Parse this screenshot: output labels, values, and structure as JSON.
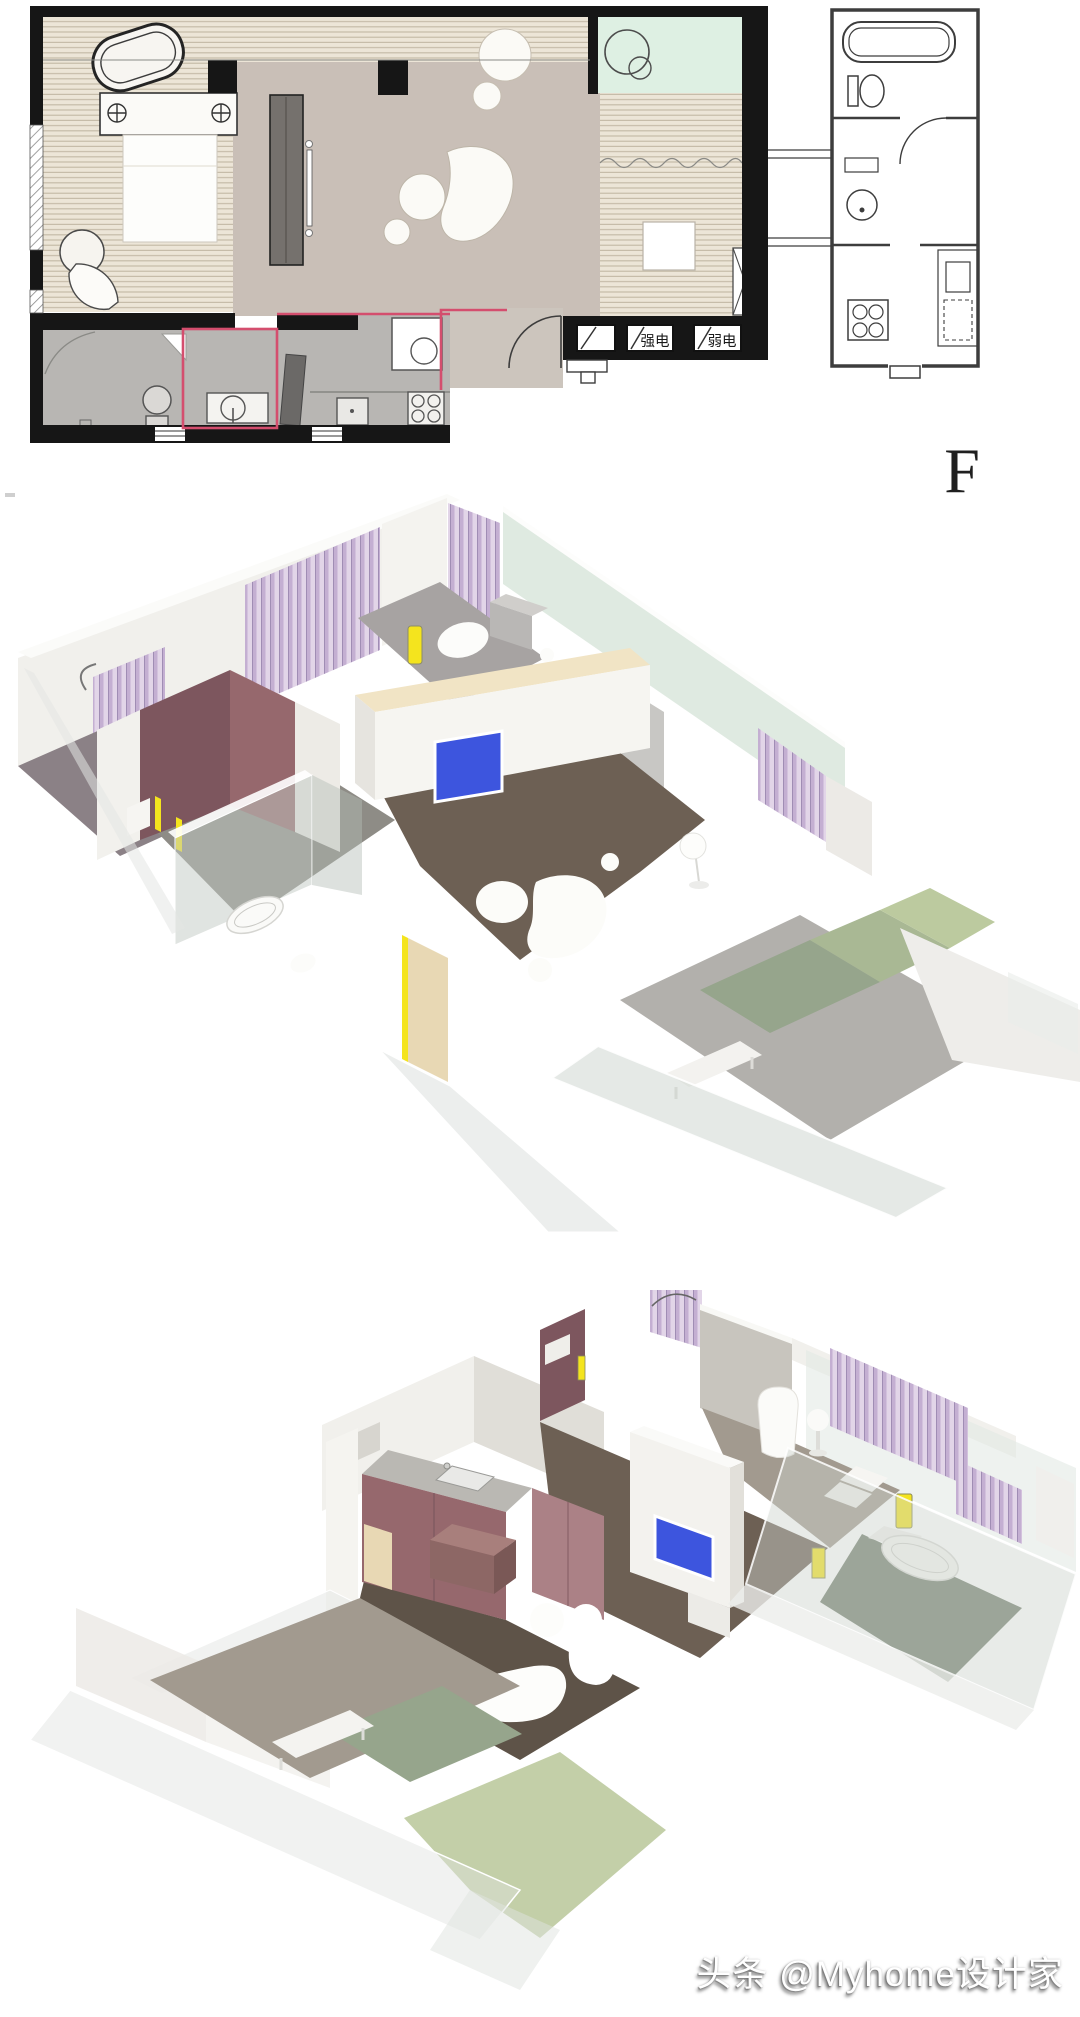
{
  "page": {
    "background": "#ffffff"
  },
  "palette": {
    "wall_black": "#161616",
    "ink": "#3d3d3d",
    "wood": "#ece5d7",
    "wood_stripe": "#c2b8a4",
    "floor_living": "#c9bfb7",
    "floor_service": "#b8b6b3",
    "balcony_plan_green": "#def0e3",
    "accent_red": "#d44e6e",
    "wall_white": "#f1f0ec",
    "wall_shadow": "#e0ded8",
    "mauve_dark": "#7d565e",
    "mauve": "#96686d",
    "mauve_light": "#ab8186",
    "curtain_a": "#e2d5e8",
    "curtain_b": "#c4afd2",
    "floor_brown": "#6d6054",
    "floor_brown_dark": "#5e5348",
    "floor_greige": "#a29a8f",
    "floor_gray": "#a7a3a2",
    "glass_green": "#dce8de",
    "mat_dark": "#96a58c",
    "mat_mid": "#a9b894",
    "mat_light": "#bcca9f",
    "tv_blue": "#3d55de",
    "accent_yellow": "#f4e41e",
    "cream": "#f1e4c5",
    "door_tan": "#e8d8b4",
    "glass_tint": "#ccd3cd"
  },
  "floor_plan": {
    "electric_strong_label": "强电",
    "electric_weak_label": "弱电",
    "plan_letter": "F"
  },
  "watermark": {
    "text": "头条 @Myhome设计家"
  }
}
